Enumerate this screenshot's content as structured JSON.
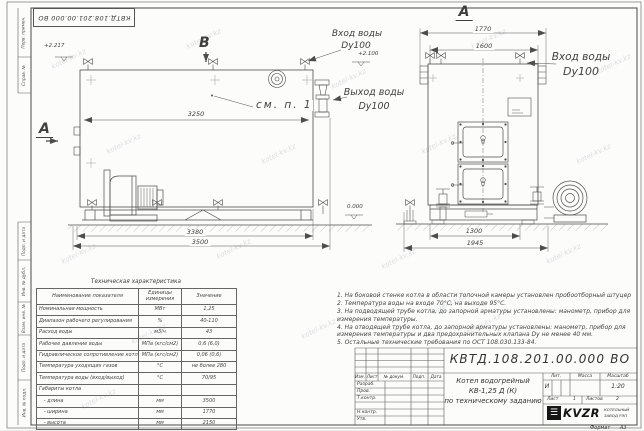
{
  "sheet": {
    "stamp_top": "КВТД.108.201.00.000 ВО",
    "watermark": "kotel-kv.kz",
    "format_label": "Формат",
    "format_value": "А3",
    "frame_labels": [
      "Перв. примен.",
      "Справ. №",
      "Подп. и дата",
      "Инв. № дубл.",
      "Взам. инв. №",
      "Подп. и дата",
      "Инв. № подл."
    ]
  },
  "views": {
    "side": {
      "b_label": "В",
      "a_label": "А",
      "see_note": "см. п. 1",
      "level_top": "+2.217",
      "level_inlet": "+2.100",
      "level_zero": "0.000",
      "dim_inner": "3250",
      "dim_frame": "3380",
      "dim_overall": "3500",
      "inlet_line1": "Вход воды",
      "inlet_line2": "Dy100",
      "outlet_line1": "Выход воды",
      "outlet_line2": "Dy100"
    },
    "front": {
      "title": "А",
      "dim_width_overall": "1770",
      "dim_width": "1600",
      "dim_base": "1300",
      "dim_base_overall": "1945",
      "inlet_line1": "Вход воды",
      "inlet_line2": "Dy100"
    }
  },
  "table": {
    "title": "Техническая характеристика",
    "headers": [
      "Наименование показателя",
      "Единицы измерения",
      "Значение"
    ],
    "rows": [
      [
        "Номинальная мощность",
        "МВт",
        "1,25"
      ],
      [
        "Диапазон рабочего регулирования",
        "%",
        "40-110"
      ],
      [
        "Расход воды",
        "м3/ч",
        "43"
      ],
      [
        "Рабочее давление воды",
        "МПа (кгс/см2)",
        "0,6 (6,0)"
      ],
      [
        "Гидравлическое сопротивление котла",
        "МПа (кгс/см2)",
        "0,06 (0,6)"
      ],
      [
        "Температура уходящих газов",
        "°С",
        "не более 280"
      ],
      [
        "Температура воды (вход/выход)",
        "°С",
        "70/95"
      ],
      [
        "Габариты котла",
        "",
        ""
      ],
      [
        "   - длина",
        "мм",
        "3500"
      ],
      [
        "   - ширина",
        "мм",
        "1770"
      ],
      [
        "   - высота",
        "мм",
        "2150"
      ]
    ]
  },
  "notes": [
    "1. На боковой стенке котла в области топочной камеры установлен пробоотборный штуцер",
    "2. Температура воды на входе 70°С, на выходе 95°С.",
    "3. На подводящей трубе котла, до запорной арматуры установлены: манометр, прибор для измерения температуры.",
    "4. На отводящей трубе котла, до запорной арматуры установлены: манометр, прибор для измерения температуры и два предохранительных клапана Dу не менее 40 мм.",
    "5. Остальные технические требования по ОСТ 108.030.133-84."
  ],
  "titleblock": {
    "doc_number": "КВТД.108.201.00.000 ВО",
    "product_lines": [
      "Котел водогрейный",
      "КВ-1,25 Д (К)",
      "по техническому заданию"
    ],
    "sig_cols": [
      "Изм.",
      "Лист",
      "№ докум.",
      "Подп.",
      "Дата"
    ],
    "sig_rows": [
      "Разраб.",
      "Пров.",
      "Т.контр.",
      "Н.контр.",
      "Утв."
    ],
    "lit_header": "Лит.",
    "mass_header": "Масса",
    "scale_header": "Масштаб",
    "lit_value": "И",
    "scale_value": "1:20",
    "sheet_label": "Лист",
    "sheet_value": "1",
    "sheets_label": "Листов",
    "sheets_value": "2",
    "logo_glyph": "☰",
    "logo_text": "KVZR",
    "logo_sub1": "КОТЕЛЬНЫЙ",
    "logo_sub2": "ЗАВОД РЭП"
  }
}
